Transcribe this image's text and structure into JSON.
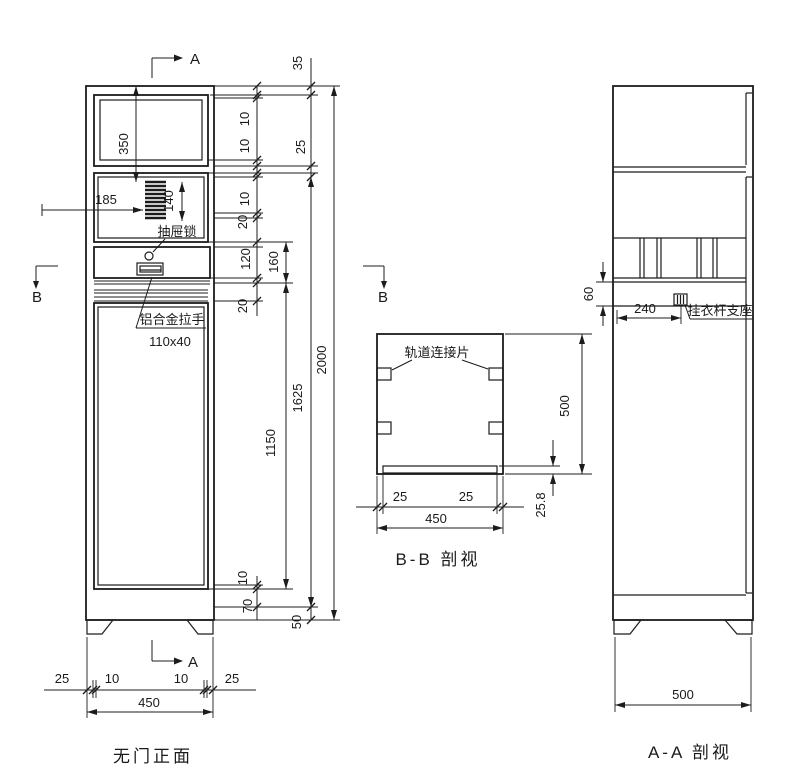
{
  "markers": {
    "a": "A",
    "b": "B"
  },
  "front": {
    "title": "无门正面",
    "ann": {
      "drawer_lock": "抽屉锁",
      "handle": "铝合金拉手",
      "handle_size": "110x40"
    },
    "dims": {
      "window_height": "350",
      "vent_offset": "185",
      "vent_height": "140",
      "chain_inner": [
        "10",
        "10",
        "10",
        "20",
        "120",
        "20"
      ],
      "chain_mid": [
        "160",
        "1150"
      ],
      "chain_outer": [
        "35",
        "25",
        "1625"
      ],
      "total_height": "2000",
      "bottom_left": [
        "10",
        "70"
      ],
      "base_height": "50",
      "base_row": [
        "25",
        "10",
        "10",
        "25"
      ],
      "width": "450"
    }
  },
  "bb": {
    "title": "B-B 剖视",
    "ann": {
      "track": "轨道连接片"
    },
    "dims": {
      "inset_left": "25",
      "inset_right": "25",
      "width": "450",
      "depth": "500",
      "base": "25.8"
    }
  },
  "aa": {
    "title": "A-A 剖视",
    "ann": {
      "rod_support": "挂衣杆支座"
    },
    "dims": {
      "rail": "60",
      "rod_offset": "240",
      "depth": "500"
    }
  }
}
